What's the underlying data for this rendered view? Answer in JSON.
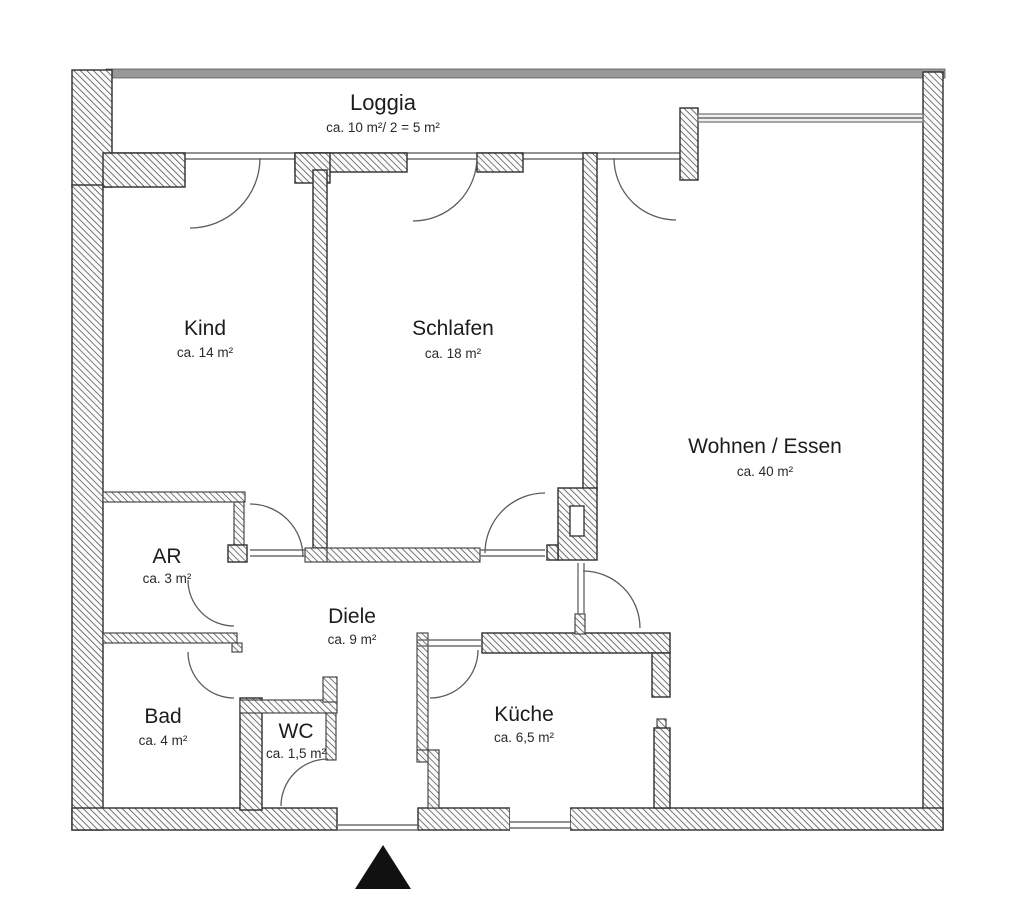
{
  "plan": {
    "type_label": "floor-plan",
    "rooms": [
      {
        "id": "loggia",
        "name": "Loggia",
        "area": "ca. 10 m²/ 2 = 5 m²"
      },
      {
        "id": "kind",
        "name": "Kind",
        "area": "ca. 14 m²"
      },
      {
        "id": "schlafen",
        "name": "Schlafen",
        "area": "ca. 18 m²"
      },
      {
        "id": "wohnen-essen",
        "name": "Wohnen / Essen",
        "area": "ca. 40 m²"
      },
      {
        "id": "ar",
        "name": "AR",
        "area": "ca. 3 m²"
      },
      {
        "id": "diele",
        "name": "Diele",
        "area": "ca. 9 m²"
      },
      {
        "id": "bad",
        "name": "Bad",
        "area": "ca. 4 m²"
      },
      {
        "id": "wc",
        "name": "WC",
        "area": "ca. 1,5 m²"
      },
      {
        "id": "kueche",
        "name": "Küche",
        "area": "ca. 6,5 m²"
      }
    ],
    "marker": {
      "name": "entrance-direction-marker",
      "color": "#111111"
    },
    "colors": {
      "background": "#ffffff",
      "wall_outline": "#2e2e2e",
      "hatch_line": "#6a6a6a",
      "top_parapet_band": "#989898",
      "door_arc": "#5c5c5c",
      "text": "#1c1c1c"
    }
  }
}
